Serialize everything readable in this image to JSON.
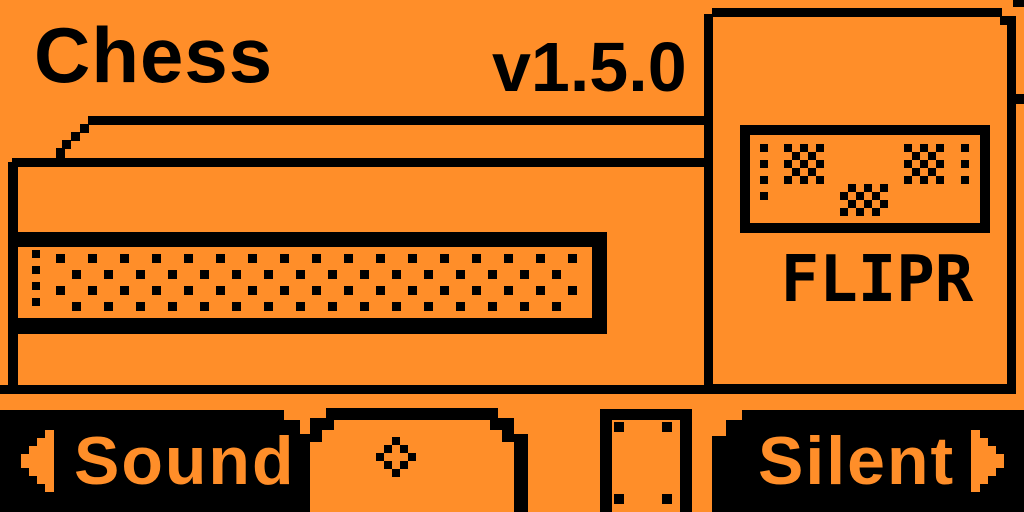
{
  "theme": {
    "background_color": "#FF8E29",
    "ink_color": "#000000"
  },
  "header": {
    "app_title": "Chess",
    "version": "v1.5.0"
  },
  "flipr_card": {
    "brand_label": "FLIPR",
    "logo_art": "dithered-photo-box"
  },
  "scene": {
    "description_icons": [
      "table-with-drawer-drawing",
      "halftone-dots",
      "ground-line",
      "stool-drawing"
    ]
  },
  "nav": {
    "left_button": {
      "label": "Sound",
      "icon": "arrow-left-icon"
    },
    "center_button": {
      "icon": "diamond-icon"
    },
    "right_button": {
      "label": "Silent",
      "icon": "arrow-right-icon"
    }
  }
}
